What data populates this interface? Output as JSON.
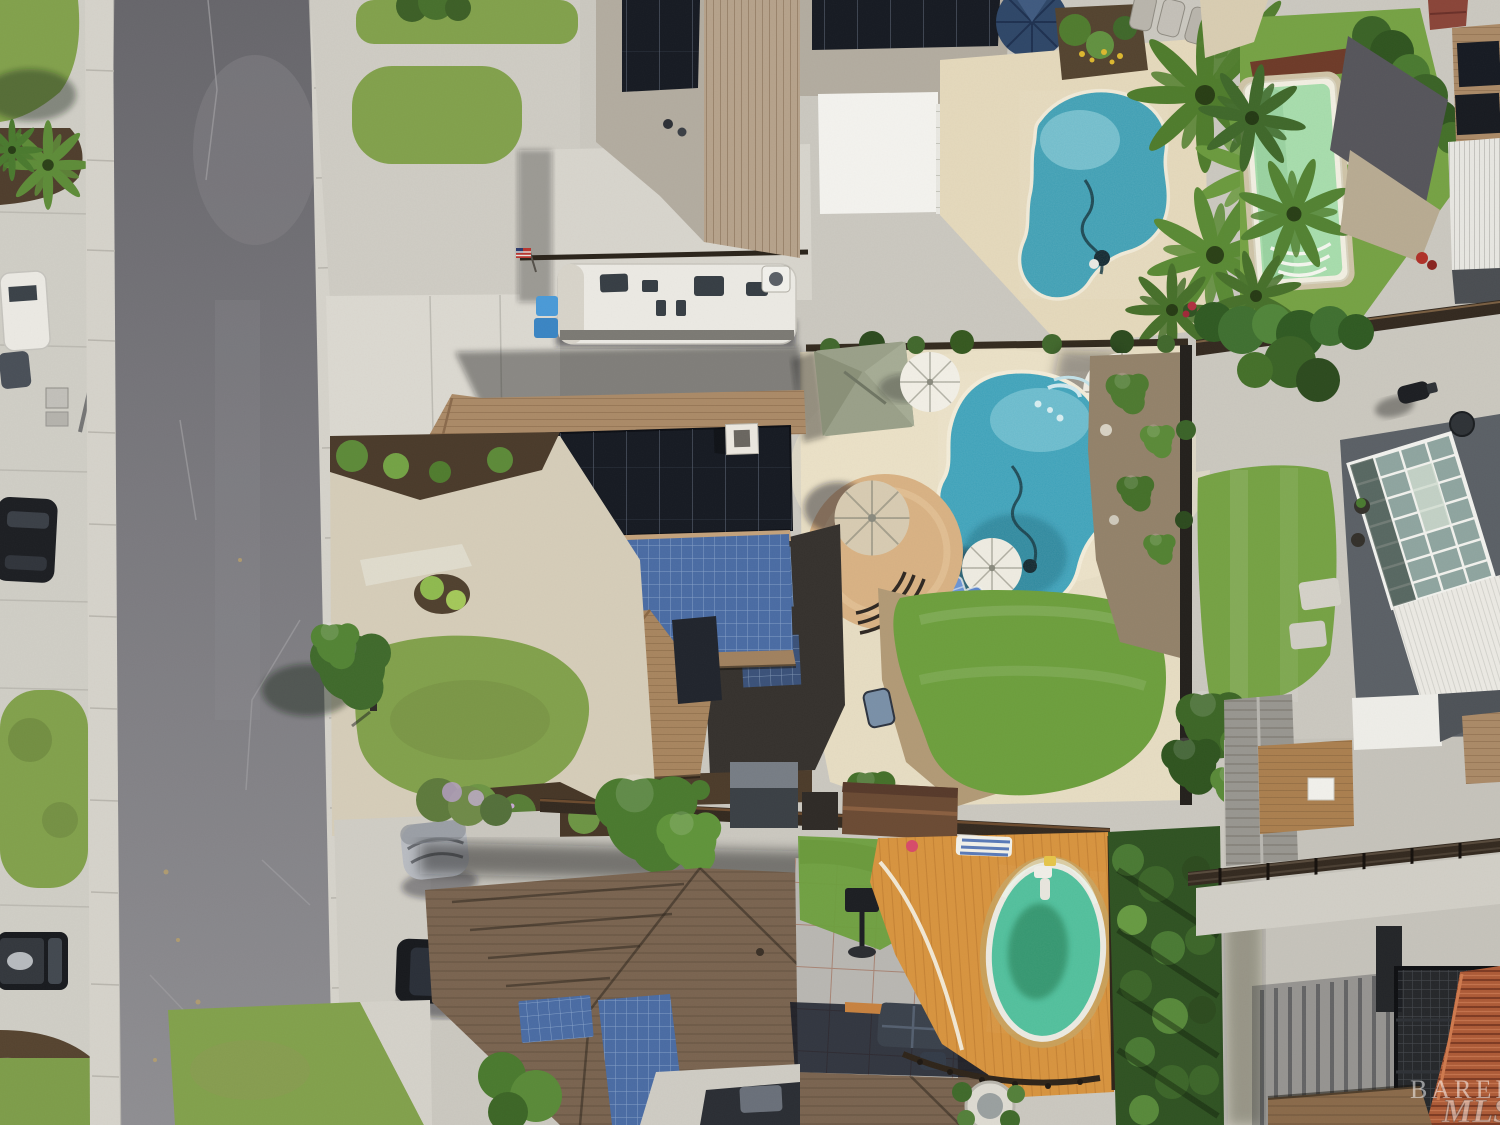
{
  "image": {
    "kind": "aerial-drone-photo",
    "description": "Overhead aerial view of a suburban neighborhood: a street with parked cars on the left, a large tan-roof house with black and blue solar arrays in the center, a freeform blue pool with umbrellas in its backyard, a neighbor pool and green lap pool at top, an oval green pool on an orange deck at bottom, and a glass conservatory roof at right.",
    "width": 1500,
    "height": 1125
  },
  "watermark": {
    "line1": "BAREIS",
    "line2": "MLS"
  },
  "colors": {
    "concrete": "#cbc8c0",
    "sidewalk": "#d6d3cb",
    "driveway": "#dcd9d1",
    "patio_back": "#e7ddc3",
    "road": "#77767b",
    "grass": "#82a14c",
    "lawn_back": "#6d9f3d",
    "lawn_right": "#76a244",
    "mulch": "#4f3d2c",
    "roof_main": "#ab8a67",
    "roof_top_gray": "#b3aca0",
    "roof_top_tan": "#b6a28b",
    "roof_bottom": "#7a6450",
    "roof_shed_gray": "#989690",
    "roof_shed_brown": "#ab7f4f",
    "solar_dark": "#161a22",
    "solar_blue": "#4a6ca4",
    "pool_main": "#3da2ba",
    "pool_top": "#3e9fb4",
    "pool_green": "#a5dcaa",
    "pool_oval": "#4fbf9b",
    "deck_orange": "#d8943f",
    "patio_circle": "#d9b284",
    "hedge": "#2f5222",
    "fence": "#33291f",
    "terracotta": "#ad5a36",
    "pergola": "#1b1d21",
    "shed_brown": "#6b4a33",
    "conservatory_glass": "#8fa5a0",
    "umbrella_white": "#f2efe6",
    "umbrella_tan": "#d8cbb2",
    "umbrella_navy": "#2e4668",
    "rv_white": "#eceae4",
    "watermark_fill": "rgba(255,255,255,0.52)"
  },
  "scene": {
    "objects": [
      "street",
      "sidewalks",
      "white-pickup-truck",
      "dark-pickup-truck",
      "silver-suv",
      "white-car",
      "black-pickup-truck",
      "black-suv",
      "covered-car",
      "travel-trailer-rv",
      "main-house-solar-roof",
      "freeform-pool",
      "patio-umbrellas",
      "gazebo",
      "top-house-solar-roof",
      "top-pool",
      "green-lap-pool",
      "palm-trees",
      "oval-above-ground-pool",
      "orange-pool-deck",
      "conservatory-glass-roof",
      "black-pergola",
      "terracotta-roof",
      "lawns",
      "hedges",
      "mls-watermark"
    ]
  }
}
